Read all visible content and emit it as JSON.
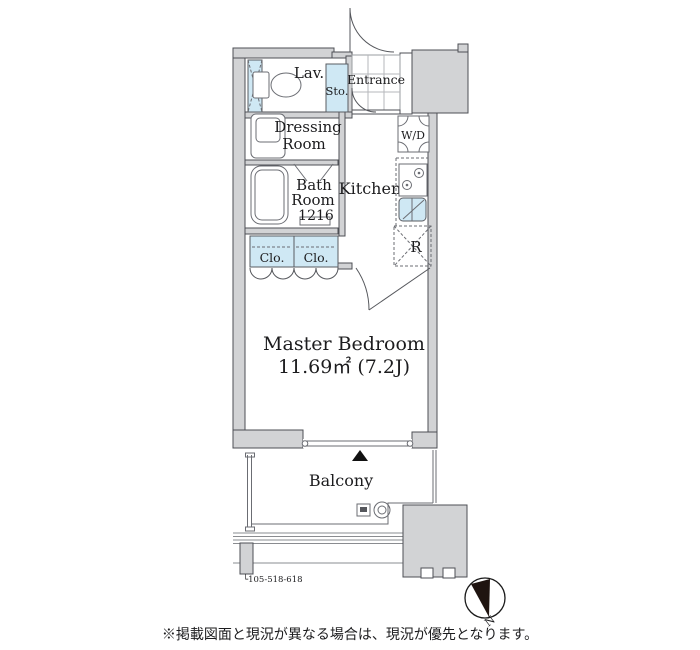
{
  "floorplan": {
    "rooms": {
      "lav": "Lav.",
      "sto": "Sto.",
      "entrance": "Entrance",
      "dressing_line1": "Dressing",
      "dressing_line2": "Room",
      "bath_line1": "Bath",
      "bath_line2": "Room",
      "bath_line3": "1216",
      "kitchen": "Kitchen",
      "washer_dryer": "W/D",
      "refrigerator": "R",
      "closet_left": "Clo.",
      "closet_right": "Clo.",
      "bedroom_name": "Master Bedroom",
      "bedroom_size": "11.69㎡ (7.2J)",
      "balcony": "Balcony"
    },
    "annotations": {
      "unit_numbers": "└105-518-618",
      "compass_north": "N"
    },
    "footer": {
      "disclaimer": "※掲載図面と現況が異なる場合は、現況が優先となります。"
    },
    "colors": {
      "wall_fill": "#d2d3d5",
      "fixture_blue": "#cfe8f4",
      "outline": "#4d4f55"
    }
  }
}
